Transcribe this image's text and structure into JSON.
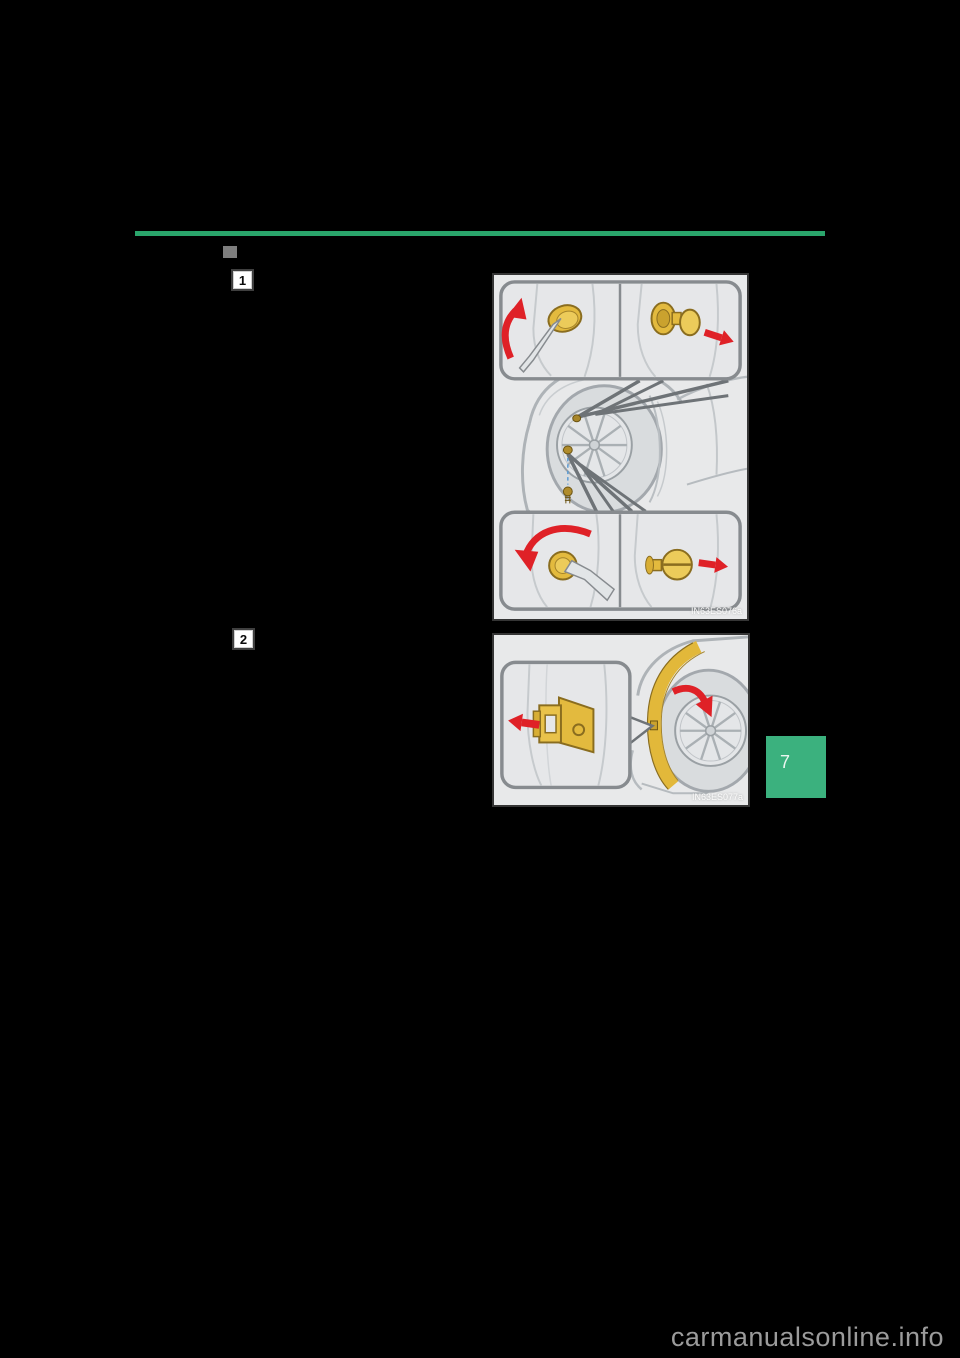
{
  "page": {
    "watermark": "carmanualsonline.info"
  },
  "section": {
    "steps": [
      {
        "number": "1"
      },
      {
        "number": "2"
      }
    ]
  },
  "figures": [
    {
      "code": "IN63ES076a"
    },
    {
      "code": "IN63ES077a"
    }
  ],
  "page_tab": {
    "number": "7"
  },
  "colors": {
    "accent_green": "#2aa56b",
    "tab_green": "#3bb17e",
    "marker_gray": "#7e7e7e",
    "clip_yellow": "#e3ba3e",
    "arrow_red": "#df2127"
  }
}
